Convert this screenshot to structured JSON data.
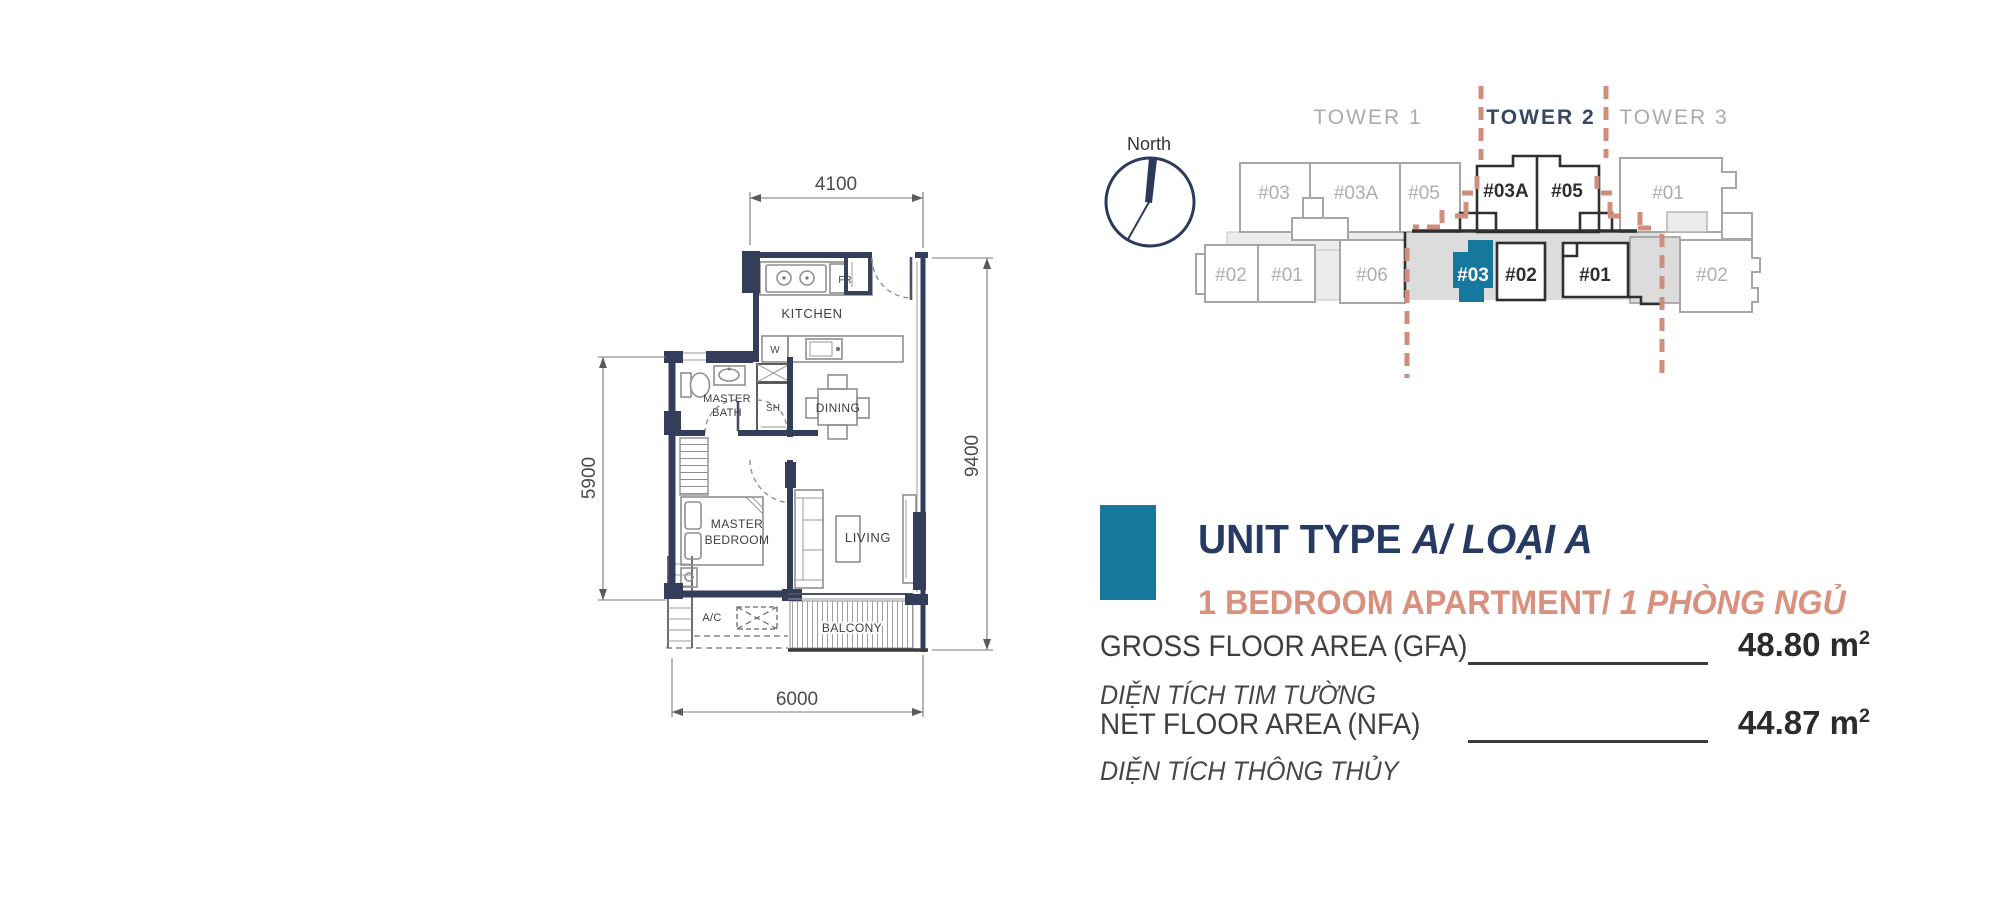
{
  "plan": {
    "dims": {
      "top": "4100",
      "right": "9400",
      "left": "5900",
      "bottom": "6000"
    },
    "rooms": {
      "kitchen": "KITCHEN",
      "fridge": "FR",
      "washer": "W",
      "master_bath_1": "MASTER",
      "master_bath_2": "BATH",
      "shower": "SH",
      "dining": "DINING",
      "bedroom_1": "MASTER",
      "bedroom_2": "BEDROOM",
      "living": "LIVING",
      "ac": "A/C",
      "balcony": "BALCONY"
    },
    "wall_color": "#343e5b"
  },
  "site": {
    "north_label": "North",
    "towers": [
      {
        "label": "TOWER 1"
      },
      {
        "label": "TOWER 2"
      },
      {
        "label": "TOWER 3"
      }
    ],
    "top_units": [
      {
        "label": "#03"
      },
      {
        "label": "#03A"
      },
      {
        "label": "#05"
      },
      {
        "label": "#03A"
      },
      {
        "label": "#05"
      },
      {
        "label": "#01"
      }
    ],
    "bottom_units": [
      {
        "label": "#02"
      },
      {
        "label": "#01"
      },
      {
        "label": "#06"
      },
      {
        "label": "#03"
      },
      {
        "label": "#02"
      },
      {
        "label": "#01"
      },
      {
        "label": "#02"
      }
    ],
    "highlighted_unit": "#03",
    "highlight_color": "#17789e",
    "boundary_color": "#cf8e7b"
  },
  "info": {
    "title_main": "UNIT TYPE ",
    "title_italic": "A/ LOẠI A",
    "subtitle_main": "1 BEDROOM APARTMENT/ ",
    "subtitle_italic": "1 PHÒNG NGỦ",
    "rows": [
      {
        "label": "GROSS FLOOR AREA (GFA)",
        "vn": "DIỆN TÍCH TIM TƯỜNG",
        "value": "48.80",
        "unit": " m",
        "sup": "2"
      },
      {
        "label": "NET FLOOR AREA (NFA)",
        "vn": "DIỆN TÍCH THÔNG THỦY",
        "value": "44.87",
        "unit": " m",
        "sup": "2"
      }
    ],
    "accent": "#17789e",
    "navy": "#263a63",
    "salmon": "#d8917f"
  }
}
